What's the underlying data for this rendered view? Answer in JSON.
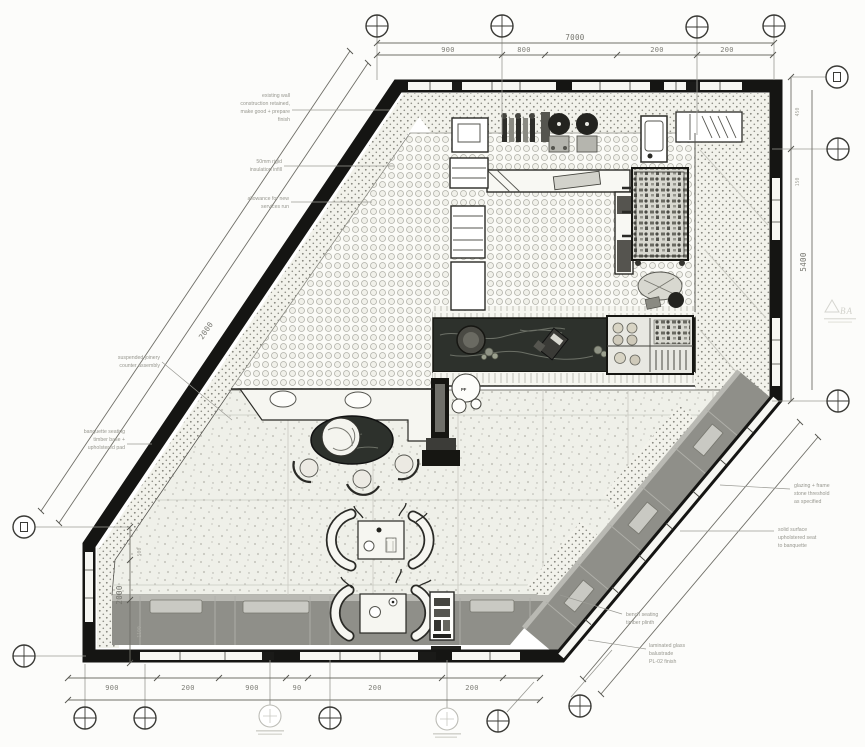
{
  "drawing": {
    "type": "cafe floor plan",
    "palette": {
      "ink": "#1b1b1b",
      "counter_marble": "#2d312c",
      "banquette_gray": "#8f8f89",
      "hatch_dot": "#84847c",
      "terrazzo": "#eff0e9"
    }
  },
  "dims": {
    "top": {
      "overall": "7000",
      "segs": [
        "900",
        "800",
        "200",
        "200"
      ]
    },
    "bottom": {
      "segs": [
        "900",
        "200",
        "900",
        "90",
        "200",
        "200"
      ]
    },
    "right": {
      "overall": "5400",
      "minor": [
        "450",
        "150"
      ]
    },
    "left": {
      "overall": "2000",
      "minor": [
        "500",
        "1100"
      ]
    },
    "diag": {
      "overall": "2000"
    }
  },
  "annotations": {
    "left": [
      {
        "lines": [
          "existing wall",
          "construction retained,",
          "make good + prepare",
          "finish"
        ]
      },
      {
        "lines": [
          "50mm rigid",
          "insulation infill"
        ]
      },
      {
        "lines": [
          "allowance for new",
          "services run"
        ]
      },
      {
        "lines": [
          "suspended joinery",
          "counter assembly"
        ]
      },
      {
        "lines": [
          "banquette seating",
          "timber base +",
          "upholstered pad"
        ]
      }
    ],
    "right": [
      {
        "lines": [
          "glazing + frame",
          "stone threshold",
          "as specified"
        ]
      },
      {
        "lines": [
          "solid surface",
          "upholstered seat",
          "to banquette"
        ]
      },
      {
        "lines": [
          "bench seating",
          "timber plinth"
        ]
      },
      {
        "lines": [
          "laminated glass",
          "balustrade",
          "PL-02 finish"
        ]
      }
    ]
  },
  "labels": {
    "planter": "PF",
    "stamp": "BA"
  }
}
